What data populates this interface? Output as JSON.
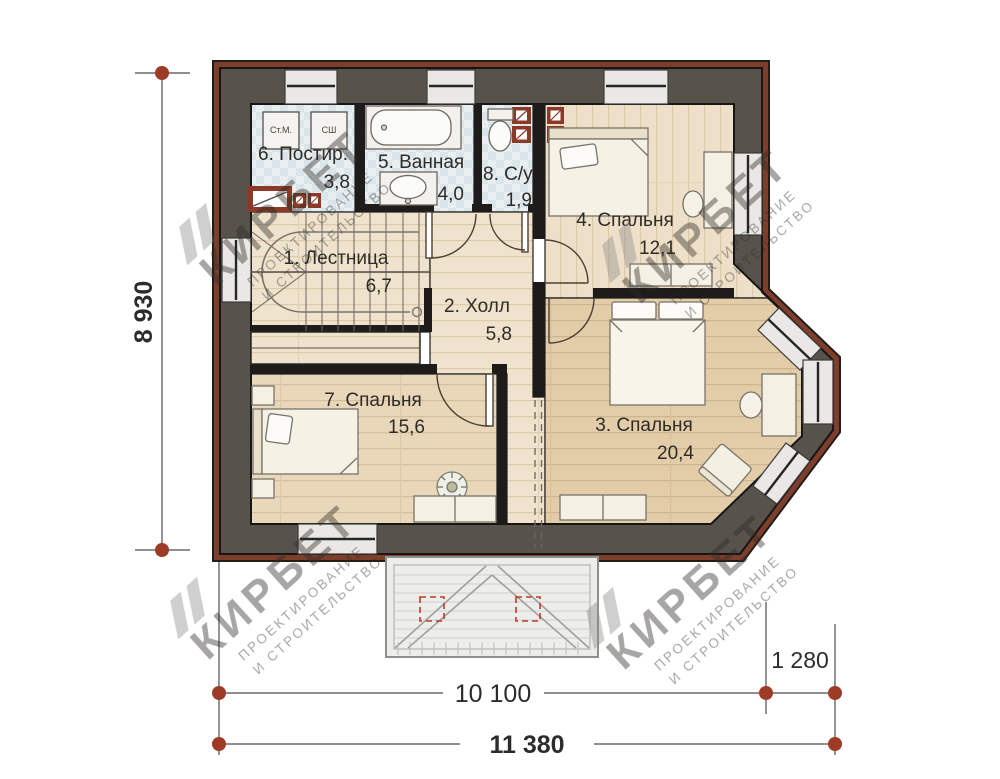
{
  "floor_plan": {
    "rooms": [
      {
        "label": "1. Лестница",
        "area": "6,7"
      },
      {
        "label": "2. Холл",
        "area": "5,8"
      },
      {
        "label": "3. Спальня",
        "area": "20,4"
      },
      {
        "label": "4. Спальня",
        "area": "12,1"
      },
      {
        "label": "5. Ванная",
        "area": "4,0"
      },
      {
        "label": "6. Постир.",
        "area": "3,8"
      },
      {
        "label": "7. Спальня",
        "area": "15,6"
      },
      {
        "label": "8. С/у",
        "area": "1,9"
      }
    ],
    "appliances": {
      "washer": "Ст.М.",
      "dryer": "СШ"
    },
    "dimensions": {
      "height": "8 930",
      "width_main": "10 100",
      "width_bay": "1 280",
      "width_total": "11 380"
    },
    "watermark": {
      "brand": "КИРБЕТ",
      "line1": "ПРОЕКТИРОВАНИЕ",
      "line2": "И СТРОИТЕЛЬСТВО"
    },
    "colors": {
      "brick": "#7d3e2b",
      "wall": "#57534b",
      "dimension_dot": "#9e3b27"
    }
  }
}
